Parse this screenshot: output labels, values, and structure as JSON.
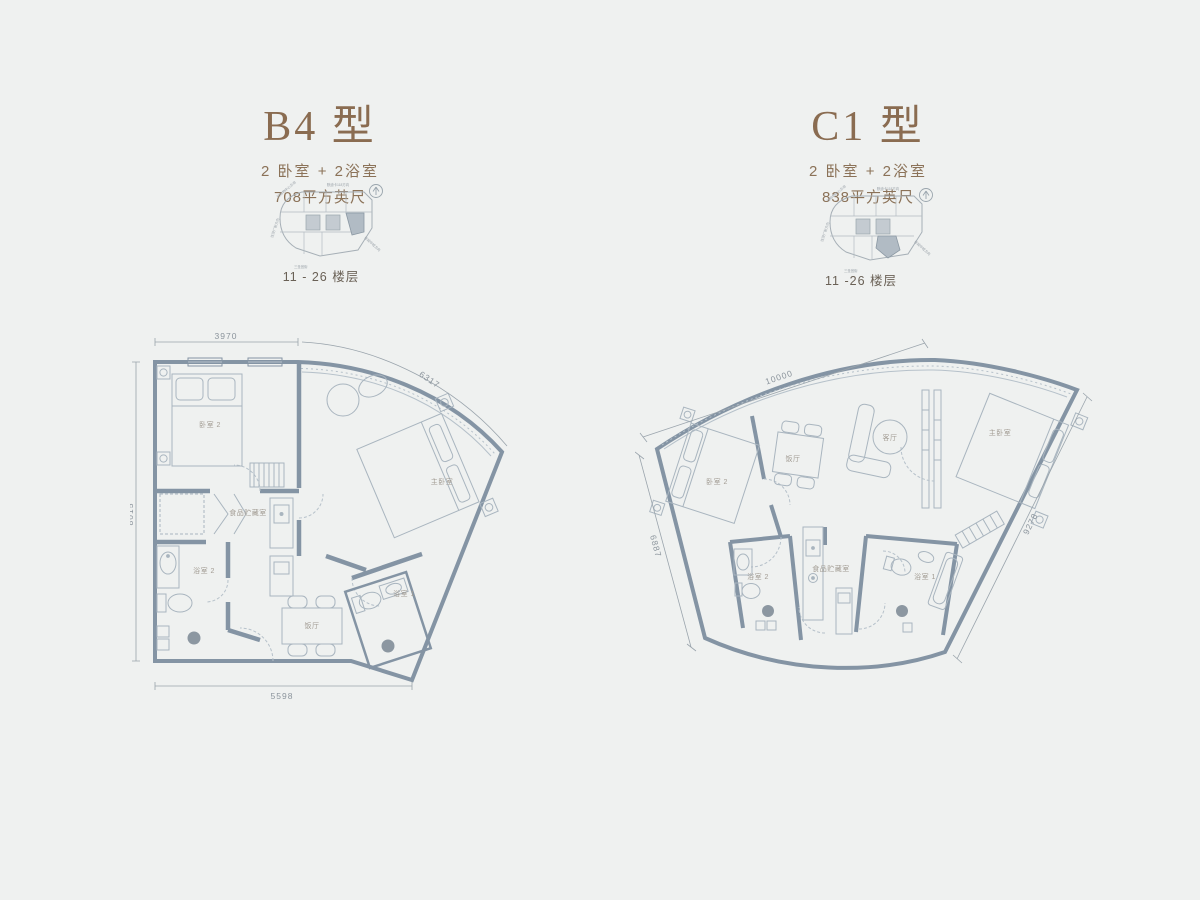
{
  "page": {
    "background": "#eff1f0"
  },
  "colors": {
    "accent_brown": "#8a6c51",
    "wall": "#8494a4",
    "furniture_line": "#a9b5bf",
    "room_label": "#a29c93",
    "dim_label": "#8b949c",
    "keyplan_highlight": "#b1bbc4",
    "floor_trap": "#8c97a1"
  },
  "b4": {
    "title": "B4 型",
    "subtitle": "2 卧室 + 2浴室",
    "area": "708平方英尺",
    "floors": "11 - 26 楼层",
    "dims": {
      "top": "3970",
      "diag": "6317",
      "left": "8015",
      "bottom": "5598"
    },
    "rooms": {
      "bedroom2": "卧室 2",
      "master": "主卧室",
      "pantry": "食品贮藏室",
      "bath2": "浴室 2",
      "dining": "饭厅",
      "bath1": "浴室 1"
    }
  },
  "c1": {
    "title": "C1 型",
    "subtitle": "2 卧室 + 2浴室",
    "area": "838平方英尺",
    "floors": "11 -26 楼层",
    "dims": {
      "top": "10000",
      "left": "6887",
      "right": "9278"
    },
    "rooms": {
      "bedroom2": "卧室 2",
      "dining": "饭厅",
      "living": "客厅",
      "master": "主卧室",
      "bath2": "浴室 2",
      "pantry": "食品贮藏室",
      "bath1": "浴室 1"
    }
  },
  "keyplan": {
    "label_top": "默迪卡118方向",
    "label_topleft": "往购物中心方向",
    "label_left": "往茨厂街方向",
    "label_bottom": "三圣宫街",
    "label_right": "往城中城方向"
  }
}
